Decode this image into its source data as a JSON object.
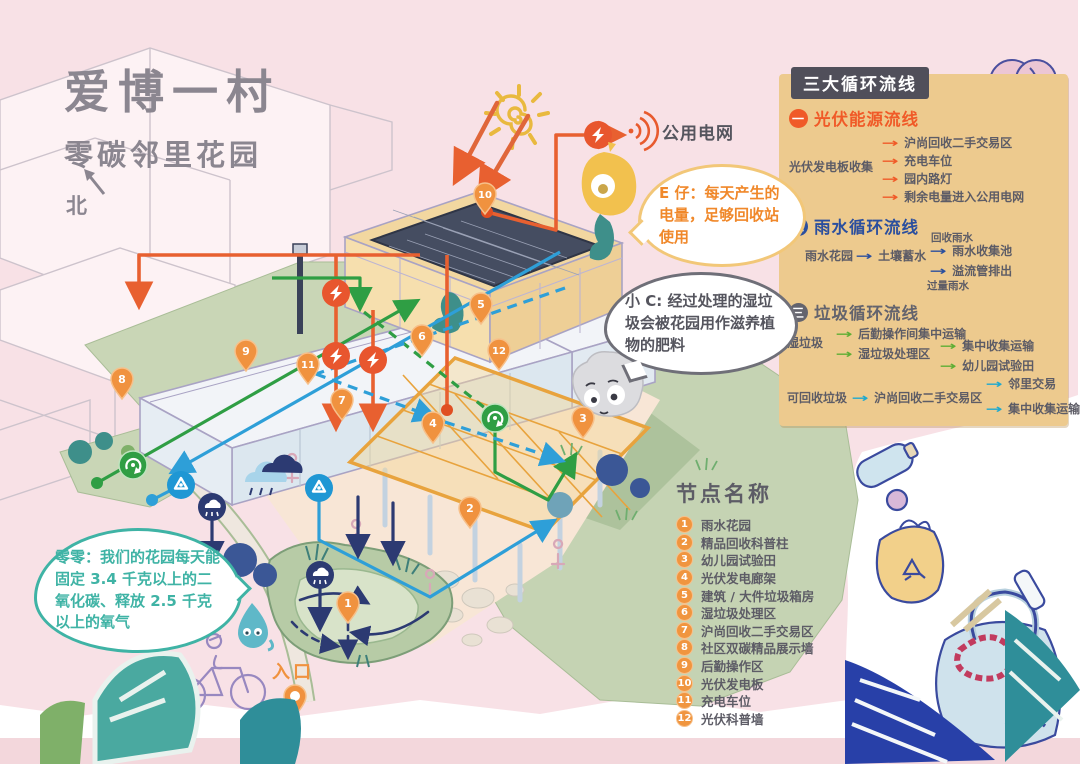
{
  "title": {
    "main": "爱博一村",
    "subtitle": "零碳邻里花园",
    "north_label": "北"
  },
  "labels": {
    "public_grid": "公用电网",
    "entrance": "入口"
  },
  "legend": {
    "header": "三大循环流线",
    "photovoltaic": {
      "num": "一",
      "title": "光伏能源流线",
      "source": "光伏发电板收集",
      "targets": [
        "沪尚回收二手交易区",
        "充电车位",
        "园内路灯",
        "剩余电量进入公用电网"
      ]
    },
    "rainwater": {
      "num": "二",
      "title": "雨水循环流线",
      "start": "雨水花园",
      "mid": "土壤蓄水",
      "branch1_label": "回收雨水",
      "branch1_target": "雨水收集池",
      "branch2_label": "过量雨水",
      "branch2_target": "溢流管排出"
    },
    "waste": {
      "num": "三",
      "title": "垃圾循环流线",
      "wet_label": "湿垃圾",
      "wet_target1": "后勤操作间集中运输",
      "wet_target2": "湿垃圾处理区",
      "wet_sub1": "集中收集运输",
      "wet_sub2": "幼儿园试验田",
      "recyclable_label": "可回收垃圾",
      "recyclable_target": "沪尚回收二手交易区",
      "recyclable_sub1": "邻里交易",
      "recyclable_sub2": "集中收集运输"
    }
  },
  "nodes": {
    "heading": "节点名称",
    "items": [
      {
        "num": "1",
        "label": "雨水花园"
      },
      {
        "num": "2",
        "label": "精品回收科普柱"
      },
      {
        "num": "3",
        "label": "幼儿园试验田"
      },
      {
        "num": "4",
        "label": "光伏发电廊架"
      },
      {
        "num": "5",
        "label": "建筑 / 大件垃圾箱房"
      },
      {
        "num": "6",
        "label": "湿垃圾处理区"
      },
      {
        "num": "7",
        "label": "沪尚回收二手交易区"
      },
      {
        "num": "8",
        "label": "社区双碳精品展示墙"
      },
      {
        "num": "9",
        "label": "后勤操作区"
      },
      {
        "num": "10",
        "label": "光伏发电板"
      },
      {
        "num": "11",
        "label": "充电车位"
      },
      {
        "num": "12",
        "label": "光伏科普墙"
      }
    ]
  },
  "bubbles": {
    "e_zai": "E 仔：每天产生的电量，足够回收站使用",
    "xiao_c": "小 C: 经过处理的湿垃圾会被花园用作滋养植物的肥料",
    "ling_ling": "零零：我们的花园每天能固定 3.4 千克以上的二氧化碳、释放 2.5 千克以上的氧气"
  },
  "map_pins": {
    "p1": "1",
    "p2": "2",
    "p3": "3",
    "p4": "4",
    "p5": "5",
    "p6": "6",
    "p7": "7",
    "p8": "8",
    "p9": "9",
    "p10": "10",
    "p11": "11",
    "p12": "12"
  },
  "colors": {
    "paper_pink": "#f8e1e6",
    "panel_tan": "#edca8e",
    "badge_dark": "#504f5a",
    "energy_orange": "#f05a28",
    "rain_blue": "#2b4f9e",
    "waste_gray": "#63636d",
    "wet_green": "#5fae35",
    "recyclable_cyan": "#1fa9cf",
    "pin_orange": "#f0953f",
    "navy": "#2c3a72"
  }
}
